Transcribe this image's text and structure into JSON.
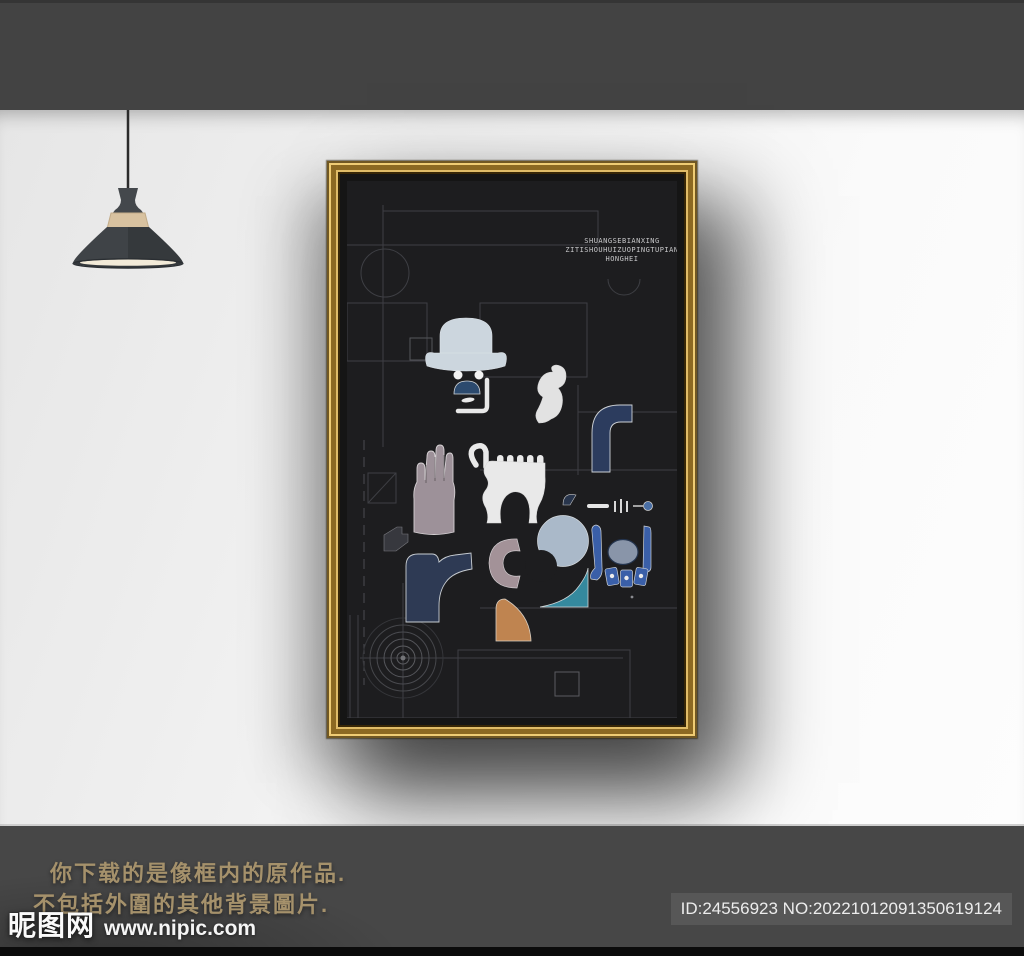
{
  "scene": {
    "top_bar_color": "#434343",
    "bottom_bar_color": "#474747",
    "lamp": {
      "cord_color": "#2b2b2b",
      "neck_color": "#44484c",
      "shade_color": "#3f4347",
      "wood_color": "#d8c2a0",
      "rim_color": "#33373b",
      "glow_color": "#f2ead8"
    }
  },
  "poster": {
    "background": "#1d1d1f",
    "title_lines": [
      "SHUANGSEBIANXING",
      "ZITISHOUHUIZUOPINGTUPIAN",
      "HONGHEI"
    ],
    "title_color": "#c7c7c9",
    "palette": {
      "hat": "#ccd6de",
      "eyes": "#f2f2f2",
      "mustache": "#2c4a6e",
      "mouth": "#e9e9e9",
      "bracket": "#e8e8e8",
      "figure": "#e2e2e2",
      "pipe": "#2c3c5e",
      "jaw": "#e9e9e9",
      "hand": "#9d9199",
      "fin": "#28354c",
      "cig_white": "#e6e6e6",
      "cig_dot": "#4a6fa5",
      "cam_blue": "#3a5fa8",
      "cam_oval": "#8995a9",
      "moon": "#aab9c9",
      "crescent": "#a39298",
      "wave": "#35899e",
      "boot": "#2e3a54",
      "flag": "#37383e",
      "quarter": "#bf8450"
    }
  },
  "footer": {
    "notice_line1": "你下载的是像框内的原作品.",
    "notice_line2": "不包括外圍的其他背景圖片.",
    "notice_color": "#a5916b",
    "brand": "昵图网",
    "site_url": "www.nipic.com",
    "id_text": "ID:24556923 NO:20221012091350619124",
    "id_badge_color": "#575757"
  }
}
